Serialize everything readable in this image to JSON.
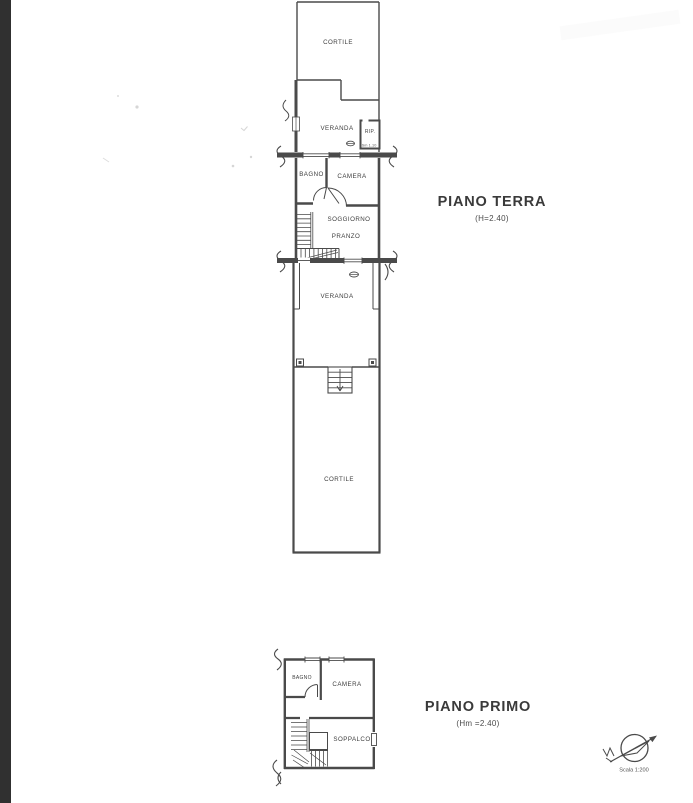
{
  "colors": {
    "ink": "#4a4a4a",
    "text": "#3c3c3c",
    "scan_strip": "#303030",
    "paper": "#ffffff"
  },
  "ground_floor": {
    "title": "PIANO TERRA",
    "height_note": "(H=2.40)",
    "labels": {
      "cortile_top": "CORTILE",
      "veranda_top": "VERANDA",
      "rip": "RIP.",
      "rip_size": "Sm 1.10",
      "bagno": "BAGNO",
      "camera": "CAMERA",
      "soggiorno": "SOGGIORNO",
      "pranzo": "PRANZO",
      "veranda_bottom": "VERANDA",
      "cortile_bottom": "CORTILE"
    }
  },
  "first_floor": {
    "title": "PIANO PRIMO",
    "height_note": "(Hm =2.40)",
    "labels": {
      "bagno": "BAGNO",
      "camera": "CAMERA",
      "soppalco": "SOPPALCO"
    }
  },
  "compass": {
    "scale": "Scala 1:200"
  }
}
